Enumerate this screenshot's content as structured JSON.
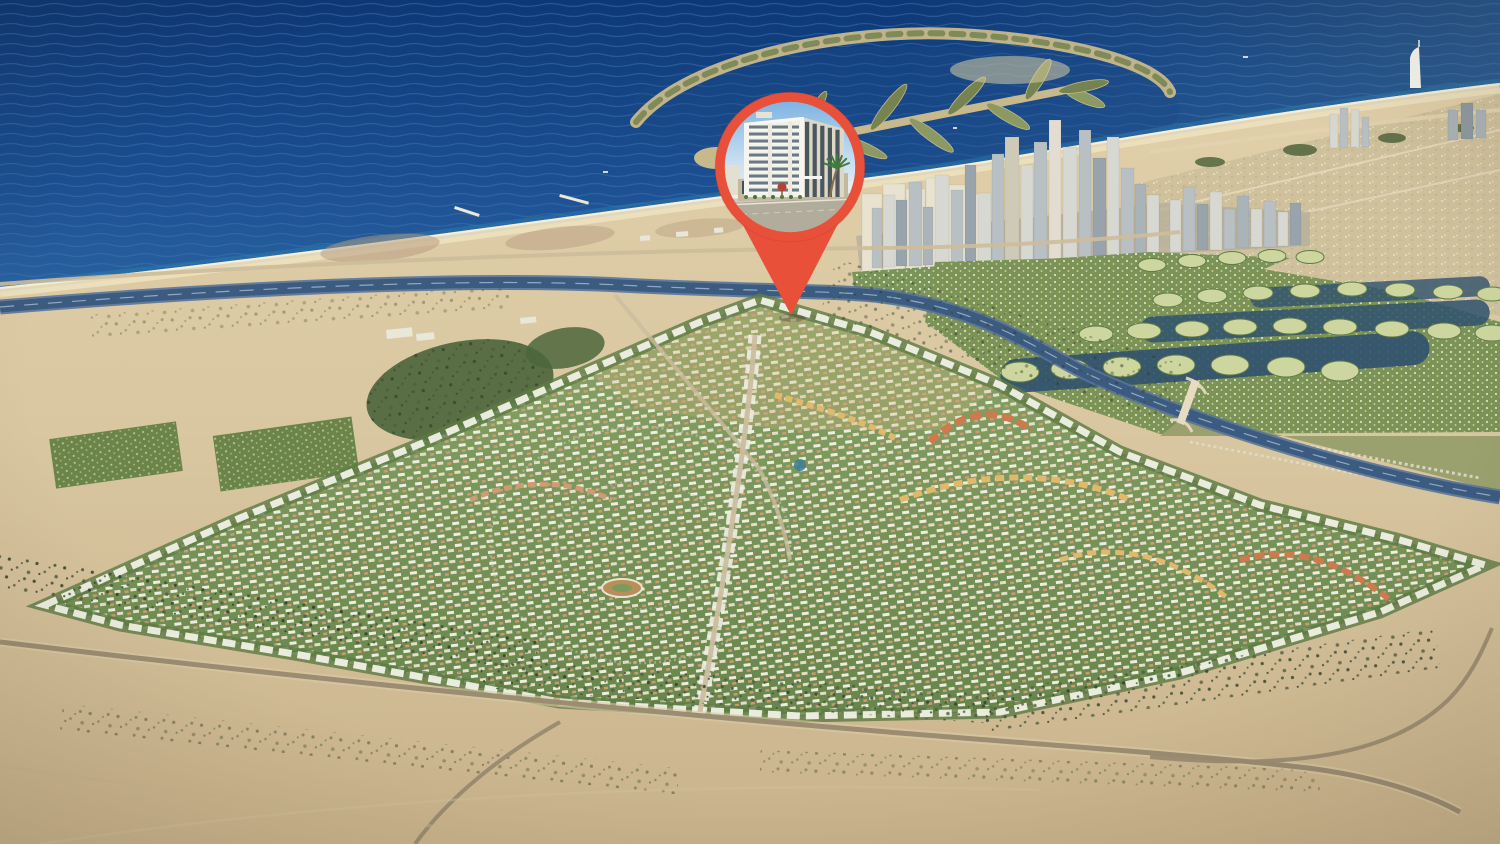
{
  "meta": {
    "type": "aerial-3d-masterplan-map",
    "width": 1500,
    "height": 844
  },
  "landmarks": {
    "sea": "open-sea",
    "palm_island": "palm-shaped-artificial-island",
    "skyline": "marina-high-rise-skyline",
    "sail_tower": "sail-shaped-hotel-tower",
    "island_clusters": "circular-villa-island-clusters",
    "masterplan": "circular-villa-masterplan-community",
    "highway": "coastal-highway",
    "desert": "desert-foreground"
  },
  "pin": {
    "icon": "map-pin",
    "color": "#e8503a",
    "content": "building-photo"
  },
  "colors": {
    "sea_top": "#0d3876",
    "sea_mid": "#1c5093",
    "sea_near": "#2f6ba6",
    "sea_right": "#4a7aa0",
    "wave": "#3f74ad",
    "surf": "#f6f1de",
    "beach": "#ecdfbd",
    "sand_hi": "#e0cfa9",
    "sand": "#d9c7a1",
    "sand_dark": "#c9b38c",
    "sand_shadow": "#b59f7b",
    "dirt": "#b49a7e",
    "green_dev": "#7d9a5c",
    "green_dev2": "#67854c",
    "green_dark": "#4e663c",
    "green_light": "#9ab275",
    "tree_dark": "#51653c",
    "villa_white": "#f4f2e6",
    "villa_cream": "#eae2cc",
    "villa_terra": "#cf9b74",
    "lake": "#2f516f",
    "cluster_fill": "#ccd69e",
    "cluster_ring": "#5f7a45",
    "highway": "#3c5b80",
    "highway_edge": "#58749a",
    "median": "#a8bdd4",
    "road": "#9b8c72",
    "road_light": "#cbbd9f",
    "bridge": "#e7dcc2",
    "urban_ground": "#b5ad9b",
    "beige_field": "#cfc19c",
    "olive_field": "#9aa06e",
    "orange_bldg": "#cf7a4e",
    "yellow_bldg": "#e0b96d",
    "palm_sand": "#c8b98c",
    "palm_green": "#74834f",
    "palm_frond": "#7d8b57",
    "pin_red": "#e8503a",
    "pin_red_dark": "#c23f2c",
    "photo_sky1": "#7eb3e2",
    "photo_sky2": "#c9dff2",
    "photo_sky3": "#eef4f8",
    "bldg_face": "#f0f1e8",
    "bldg_side": "#ddd8c6",
    "bldg_white": "#f8f8f3",
    "pier": "#eceadf",
    "glass": "#5d6c79",
    "glass_dark": "#42505a",
    "podium": "#c3b99e",
    "street": "#b2ac9c",
    "sidewalk": "#cfc9b8",
    "hedge": "#55793f",
    "trunk": "#8a6b4a",
    "frond": "#3e7c3e",
    "red_tree": "#b9422e"
  },
  "skyline": {
    "palette": [
      "#e9e2cf",
      "#d8d8d2",
      "#b9c0c4",
      "#98a3ab",
      "#cfc9b8",
      "#e2ddd0",
      "#aab3b8",
      "#8e99a1"
    ],
    "towers": [
      [
        862,
        20,
        78,
        272,
        0
      ],
      [
        883,
        22,
        88,
        272,
        0
      ],
      [
        906,
        19,
        82,
        271,
        0
      ],
      [
        926,
        22,
        92,
        270,
        0
      ],
      [
        949,
        20,
        84,
        269,
        0
      ],
      [
        970,
        18,
        74,
        268,
        0
      ],
      [
        872,
        10,
        60,
        268,
        2
      ],
      [
        883,
        12,
        72,
        267,
        1
      ],
      [
        896,
        11,
        66,
        266,
        3
      ],
      [
        909,
        13,
        84,
        266,
        2
      ],
      [
        923,
        10,
        58,
        265,
        6
      ],
      [
        935,
        14,
        90,
        265,
        1
      ],
      [
        951,
        12,
        74,
        264,
        2
      ],
      [
        965,
        11,
        98,
        263,
        3
      ],
      [
        978,
        13,
        70,
        263,
        1
      ],
      [
        992,
        12,
        108,
        262,
        2
      ],
      [
        1005,
        14,
        125,
        262,
        4
      ],
      [
        1021,
        12,
        96,
        261,
        1
      ],
      [
        1034,
        13,
        118,
        260,
        2
      ],
      [
        1049,
        12,
        140,
        260,
        5
      ],
      [
        1063,
        14,
        112,
        259,
        1
      ],
      [
        1079,
        12,
        128,
        258,
        2
      ],
      [
        1093,
        13,
        100,
        258,
        3
      ],
      [
        1107,
        12,
        120,
        257,
        1
      ],
      [
        1121,
        13,
        88,
        256,
        2
      ],
      [
        1135,
        11,
        72,
        256,
        6
      ],
      [
        1147,
        12,
        60,
        255,
        1
      ],
      [
        1170,
        11,
        52,
        252,
        1
      ],
      [
        1183,
        12,
        64,
        251,
        2
      ],
      [
        1197,
        11,
        46,
        250,
        3
      ],
      [
        1210,
        12,
        58,
        250,
        1
      ],
      [
        1224,
        11,
        40,
        249,
        2
      ],
      [
        1237,
        12,
        52,
        248,
        6
      ],
      [
        1251,
        11,
        38,
        247,
        1
      ],
      [
        1264,
        12,
        46,
        247,
        2
      ],
      [
        1278,
        10,
        34,
        246,
        1
      ],
      [
        1290,
        11,
        42,
        245,
        3
      ],
      [
        1330,
        8,
        34,
        148,
        1
      ],
      [
        1340,
        8,
        40,
        148,
        2
      ],
      [
        1351,
        8,
        38,
        147,
        1
      ],
      [
        1362,
        7,
        30,
        147,
        2
      ],
      [
        1448,
        10,
        30,
        140,
        6
      ],
      [
        1461,
        12,
        36,
        139,
        7
      ],
      [
        1476,
        10,
        28,
        138,
        6
      ]
    ]
  },
  "islands": {
    "rows": [
      {
        "rx": 14,
        "ry": 6.5,
        "pts": [
          [
            1152,
            265
          ],
          [
            1192,
            261
          ],
          [
            1232,
            258
          ],
          [
            1272,
            256
          ],
          [
            1310,
            257
          ]
        ]
      },
      {
        "rx": 15,
        "ry": 7,
        "pts": [
          [
            1168,
            300
          ],
          [
            1212,
            296
          ],
          [
            1258,
            293
          ],
          [
            1305,
            291
          ],
          [
            1352,
            289
          ],
          [
            1400,
            290
          ],
          [
            1448,
            292
          ],
          [
            1492,
            294
          ]
        ]
      },
      {
        "rx": 17,
        "ry": 8,
        "pts": [
          [
            1096,
            334
          ],
          [
            1144,
            331
          ],
          [
            1192,
            329
          ],
          [
            1240,
            327
          ],
          [
            1290,
            326
          ],
          [
            1340,
            327
          ],
          [
            1392,
            329
          ],
          [
            1444,
            331
          ],
          [
            1492,
            333
          ]
        ]
      },
      {
        "rx": 19,
        "ry": 10,
        "pts": [
          [
            1020,
            372
          ],
          [
            1070,
            369
          ],
          [
            1122,
            367
          ],
          [
            1176,
            365
          ],
          [
            1230,
            365
          ],
          [
            1286,
            367
          ],
          [
            1340,
            371
          ]
        ]
      }
    ]
  },
  "palm": {
    "spine": [
      [
        718,
        158
      ],
      [
        1066,
        90
      ]
    ],
    "fronds": 10,
    "frond_len": [
      62,
      40
    ],
    "spread": 34
  },
  "photo": {
    "floors": 10,
    "right_strips": 5,
    "storefronts": 6,
    "palm_fronds": 7,
    "shrubs": 7
  }
}
